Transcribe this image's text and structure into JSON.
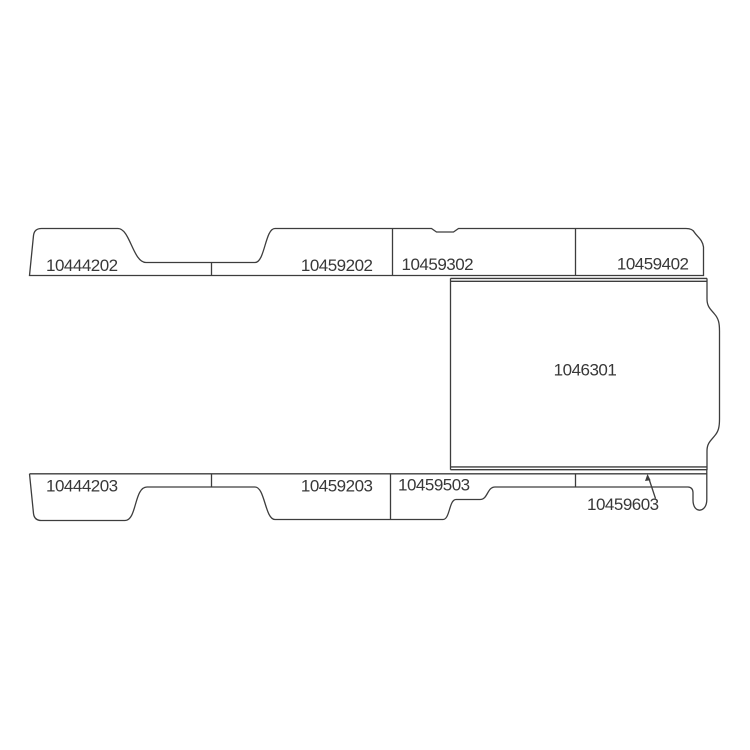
{
  "parts": {
    "top_row": [
      "10444202",
      "10459202",
      "10459302",
      "10459402"
    ],
    "center_panel": "1046301",
    "bottom_row": [
      "10444203",
      "10459203",
      "10459503",
      "10459603"
    ]
  },
  "colors": {
    "line": "#3d3d3d",
    "text": "#383838",
    "background": "#ffffff"
  }
}
